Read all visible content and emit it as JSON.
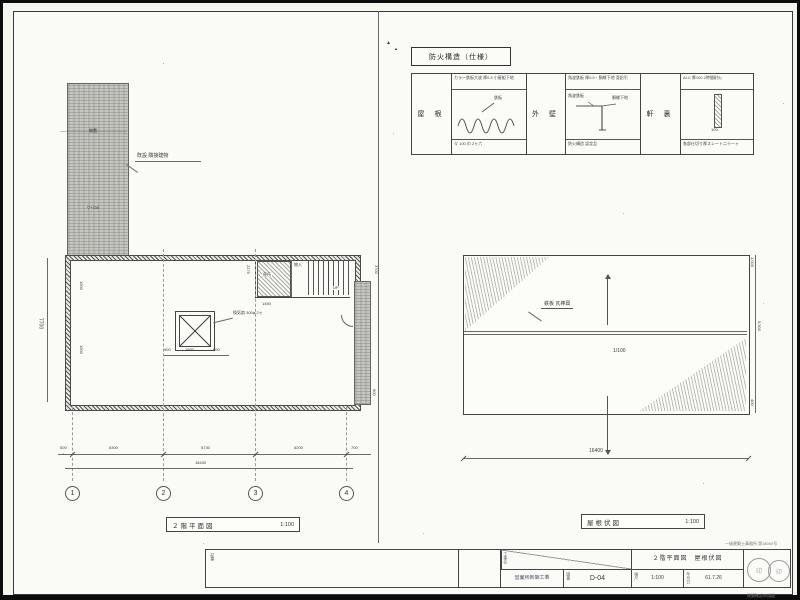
{
  "legend": {
    "title": "防火構造（仕様）",
    "sections": [
      {
        "label": "屋 根",
        "spec_top": "カラー鉄板大波 厚0.5 小屋組下地",
        "callout": "鉄板",
        "spec_bottom": "々 100 巾 2ヶ六"
      },
      {
        "label": "外 壁",
        "spec_top": "角波鉄板 厚0.5・胴縁下地 亜鉛引",
        "callout_a": "角波鉄板",
        "callout_b": "胴縁下地",
        "spec_bottom": "防火構造 認定品"
      },
      {
        "label": "軒 裏",
        "spec_top": "ALC 厚100 2時間耐火",
        "callout": "100",
        "spec_bottom": "各部仕切り厚スレート二十一ヶ"
      }
    ]
  },
  "existing": {
    "label": "既設 隣接建物",
    "inner_label": "物置",
    "level_label": "▽+700"
  },
  "floor_plan": {
    "title": "２階平面図",
    "scale": "1:100",
    "vent_label": "換気扇 300φ 2ヶ",
    "room_label": "便所",
    "closet_label": "物入",
    "stair_label": "UP",
    "dim_2275": "2275",
    "dim_1450": "1450",
    "dim_left": "7700",
    "dim_right": "3700",
    "dim_right2": "600",
    "dim_900a": "900",
    "dim_1800": "1800",
    "dim_900b": "900",
    "dim_1500a": "1500",
    "dim_1500b": "1500",
    "bottom_dims": [
      "500",
      "6300",
      "5730",
      "6200",
      "700"
    ],
    "bottom_total": "18430",
    "grid": [
      "1",
      "2",
      "3",
      "4"
    ]
  },
  "roof_plan": {
    "title": "屋根伏図",
    "scale": "1:100",
    "material_label": "鉄板 瓦棒葺",
    "slope_label": "1/100",
    "dim_top_right": "1,000",
    "dim_right": "9,500",
    "dim_bottom_right": "400",
    "dim_total": "16400"
  },
  "title_block": {
    "drawing_titles": "２階平面図　屋根伏図",
    "project": "営業所新築工事",
    "sheet_no": "D-04",
    "scale": "1:100",
    "date": "61.7.26",
    "labels": {
      "name": "工事名",
      "number": "図番",
      "scale": "縮尺",
      "date": "年月日"
    },
    "note_top": "一級建築士事務所 第18000号",
    "note_bottom": "建築確認申請図",
    "revision_header": "記事",
    "stamp_a": "印",
    "stamp_b": "印"
  },
  "marks": {
    "fold": "▲"
  }
}
